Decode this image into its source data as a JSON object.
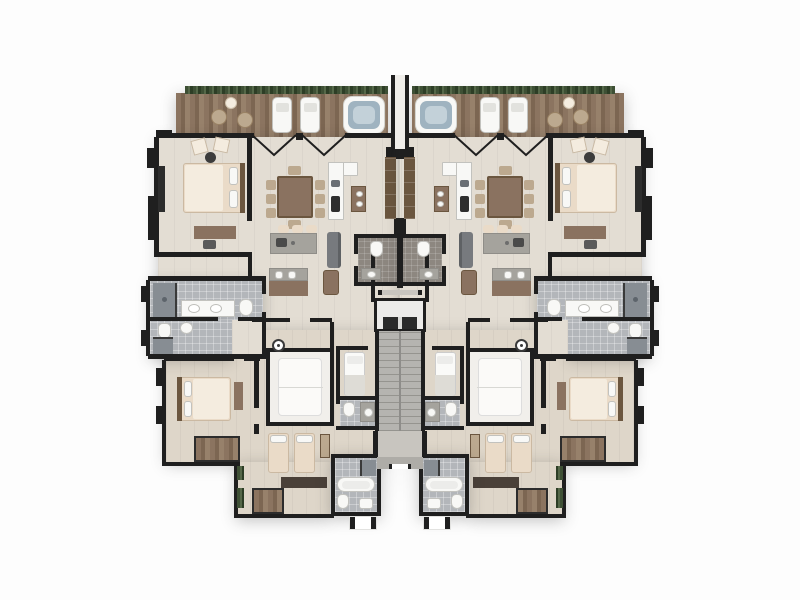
{
  "meta": {
    "type": "architectural-floor-plan",
    "description": "Top-down 3D rendered floor plan of two mirrored apartment units sharing a central elevator and staircase core, with a continuous front terrace"
  },
  "palette": {
    "bg": "#fdfdfd",
    "halo": "rgba(90,90,90,0.16)",
    "shadow": "rgba(50,50,50,0.28)",
    "wall": "#1f1f1f",
    "floor": "#e3ddd3",
    "floor2": "#ded6c9",
    "deck_a": "#8b7460",
    "deck_b": "#7c6652",
    "deck_c": "#97816b",
    "hedge_a": "#3e5035",
    "hedge_b": "#556849",
    "hedge_c": "#2d3e26",
    "tile": "#b3b6ba",
    "tile_dark": "#878d93",
    "powder": "#8d8780",
    "fixture": "#f8f8f6",
    "fixture_border": "#c2c2be",
    "wood": "#8a7260",
    "wood_light": "#bca98f",
    "wood_dark": "#6b563f",
    "linen": "#eadbc8",
    "linen_light": "#f4ecdf",
    "gray_top": "#a5a39d",
    "sofa": "#777a7e",
    "water": "#9fb3c0",
    "water_light": "#c3d1d9",
    "stair": "#b5b4b0",
    "stair_line": "#95948f",
    "landing": "#c8c5bf",
    "entry": "#aeaca7"
  },
  "scene": {
    "units": [
      {
        "id": "unit-left"
      },
      {
        "id": "unit-right",
        "mirrored_from": "unit-left"
      }
    ],
    "shared_core": [
      "divider-wall",
      "powder-rooms",
      "elevator",
      "staircase",
      "entry-landing"
    ],
    "unit_rooms": {
      "terrace": [
        "hedge-planter",
        "bistro-table x2",
        "floor-lamp",
        "lounge-chair x2",
        "hot-tub",
        "folding-glass-doors"
      ],
      "master-bedroom": [
        "king-bed",
        "accent-chair x2",
        "round-side-table",
        "desk-console",
        "wardrobe"
      ],
      "living-dining": [
        "dining-table",
        "dining-chair x8",
        "kitchen-island",
        "bar-stool x3",
        "tv-console",
        "sofa",
        "armchair"
      ],
      "kitchen": [
        "l-shaped-counter",
        "sink",
        "cooktop",
        "pantry-cabinet",
        "bar-cabinet"
      ],
      "master-bathroom": [
        "walk-in-shower",
        "double-vanity",
        "toilet"
      ],
      "second-bathroom": [
        "toilet",
        "sink",
        "shower"
      ],
      "bedroom-2": [
        "double-bed",
        "closet"
      ],
      "flex-room": [
        "daybed"
      ],
      "bedroom-3": [
        "twin-bed x2",
        "desk",
        "closet",
        "planter x2"
      ],
      "junior-bedroom": [
        "single-bed"
      ],
      "junior-bathroom": [
        "toilet",
        "vanity"
      ],
      "lower-bathroom": [
        "shower",
        "bathtub",
        "toilet",
        "sink"
      ],
      "powder-room": [
        "toilet",
        "vanity"
      ]
    }
  }
}
